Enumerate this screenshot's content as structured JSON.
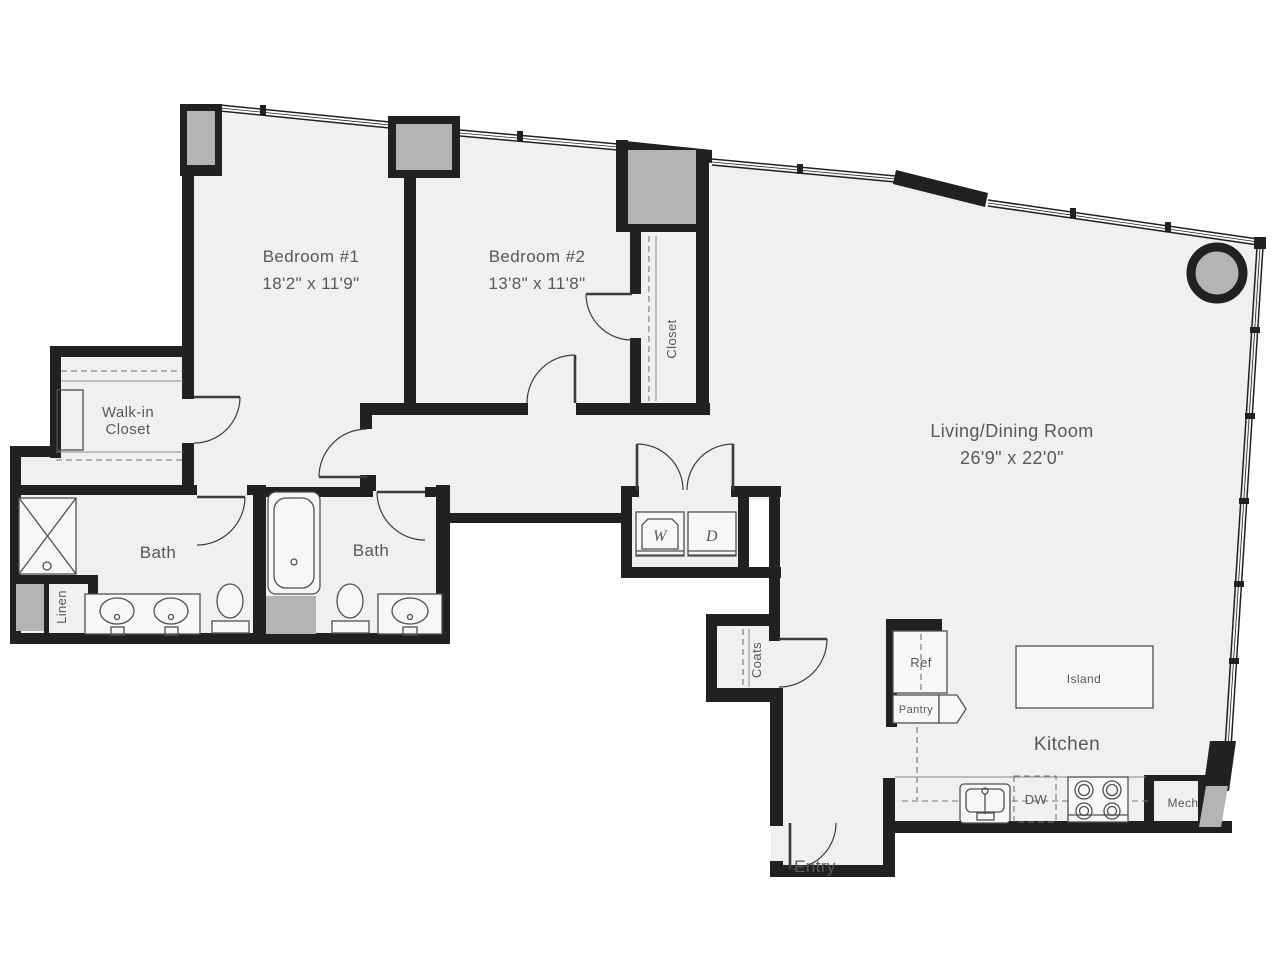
{
  "floorplan": {
    "labels": {
      "bedroom1_name": "Bedroom #1",
      "bedroom1_dims": "18'2\" x 11'9\"",
      "bedroom2_name": "Bedroom #2",
      "bedroom2_dims": "13'8\" x 11'8\"",
      "living_name": "Living/Dining Room",
      "living_dims": "26'9\" x 22'0\"",
      "kitchen": "Kitchen",
      "bath1": "Bath",
      "bath2": "Bath",
      "walkin_line1": "Walk-in",
      "walkin_line2": "Closet",
      "closet": "Closet",
      "linen": "Linen",
      "coats": "Coats",
      "entry": "Entry",
      "washer": "W",
      "dryer": "D",
      "ref": "Ref",
      "pantry": "Pantry",
      "island": "Island",
      "dishwasher": "DW",
      "mech": "Mech"
    },
    "colors": {
      "wall": "#212121",
      "floor": "#f0f0f1",
      "column": "#b3b4b6",
      "label": "#57585b",
      "fixture": "#4f5052",
      "background": "#ffffff"
    }
  }
}
